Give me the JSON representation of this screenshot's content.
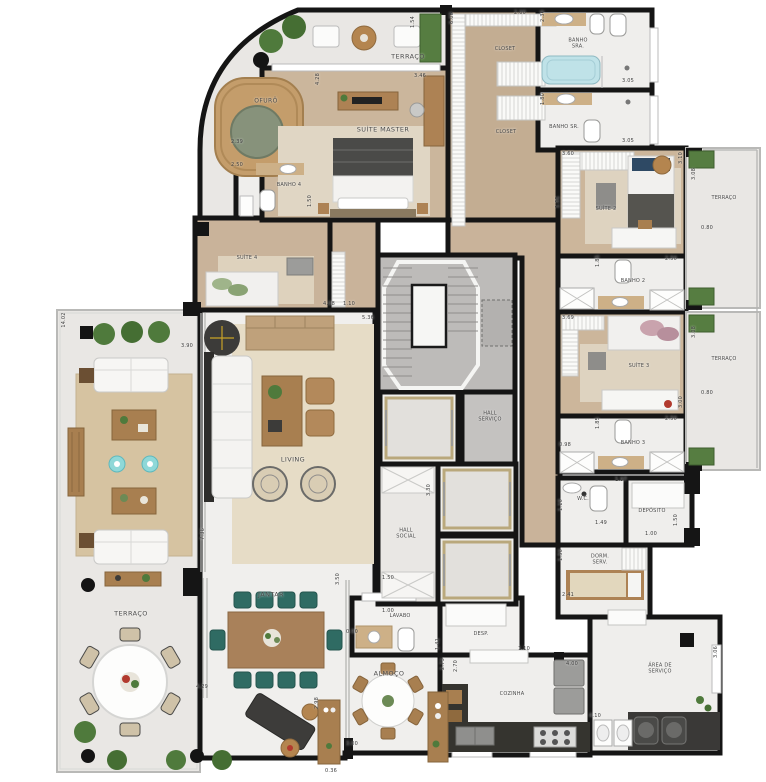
{
  "plan": {
    "type": "apartment-floor-plan",
    "rooms": {
      "terraco_top": "TERRAÇO",
      "ofuro": "OFURÔ",
      "suite_master": "SUÍTE MASTER",
      "banho_4": "BANHO 4",
      "suite_4": "SUÍTE 4",
      "closet_upper": "CLOSET",
      "closet_lower": "CLOSET",
      "banho_sra": "BANHO SRA.",
      "banho_sr": "BANHO SR.",
      "suite_2": "SUÍTE 2",
      "terraco_right_upper": "TERRAÇO",
      "banho_2": "BANHO 2",
      "suite_3": "SUÍTE 3",
      "terraco_right_lower": "TERRAÇO",
      "banho_3": "BANHO 3",
      "wc": "W.C.",
      "deposito": "DEPÓSITO",
      "dorm_serv": "DORM. SERV.",
      "hall_servico": "HALL SERVIÇO",
      "hall_social": "HALL SOCIAL",
      "living": "LIVING",
      "terraco_left": "TERRAÇO",
      "jantar": "JANTAR",
      "almoco": "ALMOÇO",
      "lavabo": "LAVABO",
      "desp": "DESP.",
      "cozinha": "COZINHA",
      "area_servico": "ÁREA DE SERVIÇO"
    },
    "dims": {
      "d01": "1.54",
      "d02": "2.00",
      "d03": "6.08",
      "d04": "2.30",
      "d05": "3.05",
      "d06": "1.80",
      "d07": "3.05",
      "d08": "4.28",
      "d09": "3.46",
      "d10": "2.39",
      "d11": "2.50",
      "d12": "1.50",
      "d13": "4.08",
      "d14": "1.10",
      "d15": "5.36",
      "d16": "3.90",
      "d17": "14.02",
      "d18": "7.36",
      "d19": "3.60",
      "d20": "1.91",
      "d21": "3.10",
      "d22": "3.08",
      "d23": "0.80",
      "d24": "1.85",
      "d25": "2.50",
      "d26": "3.69",
      "d27": "3.00",
      "d28": "3.08",
      "d29": "0.80",
      "d30": "1.85",
      "d31": "2.50",
      "d32": "0.98",
      "d33": "1.97",
      "d34": "1.10",
      "d35": "1.49",
      "d36": "1.50",
      "d37": "1.00",
      "d38": "1.50",
      "d39": "2.41",
      "d40": "3.30",
      "d41": "1.50",
      "d42": "1.00",
      "d43": "0.90",
      "d44": "1.41",
      "d45": "2.73",
      "d46": "2.70",
      "d47": "1.10",
      "d48": "4.00",
      "d49": "4.10",
      "d50": "3.06",
      "d51": "3.00",
      "d52": "2.98",
      "d53": "3.50",
      "d54": "4.29",
      "d55": "0.36"
    },
    "colors": {
      "wall": "#1a1a1a",
      "wood_floor": "#c9b39a",
      "tile_floor": "#efeeec",
      "terrace_floor": "#e9e7e4",
      "rug": "#e3d8c2",
      "teal_chair": "#2f6b63",
      "cyan_stool": "#8fd8d8",
      "plant": "#4f7a3c",
      "bathtub": "#bfe2e8",
      "counter_wood": "#cdb087",
      "dark_counter": "#35342f"
    }
  }
}
